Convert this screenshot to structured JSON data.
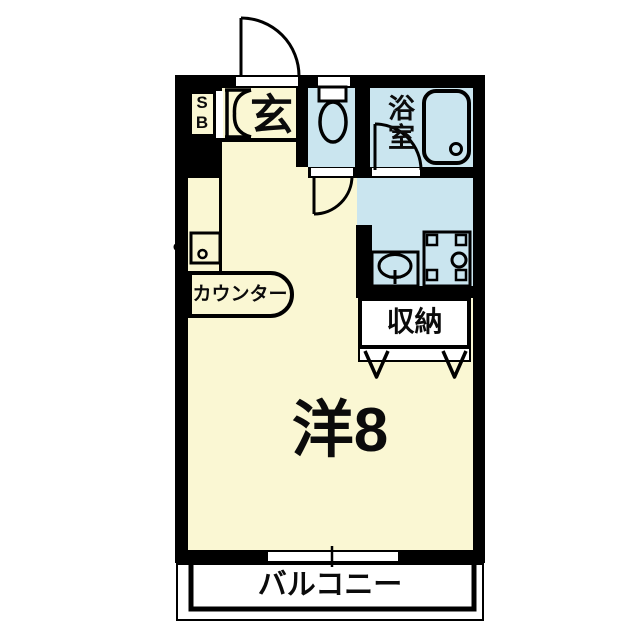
{
  "plan_type": "apartment-floor-plan",
  "rooms": {
    "shoe_box": {
      "label": "SB"
    },
    "entrance": {
      "label": "玄"
    },
    "bathroom": {
      "label": "浴室"
    },
    "counter": {
      "label": "カウンター"
    },
    "storage": {
      "label": "収納"
    },
    "main_room": {
      "label": "洋8"
    },
    "balcony": {
      "label": "バルコニー"
    }
  },
  "colors": {
    "floor": "#faf7d3",
    "wet_area": "#cae5ef",
    "wall": "#000000",
    "balcony": "#ffffff"
  },
  "icons": {
    "entrance-door-icon": "quarter-circle door swing at top wall",
    "shoebox-door-icon": "bi-fold bracket door next to SB",
    "toilet-icon": "tank rectangle with bowl oval",
    "toilet-door-icon": "quarter-circle door swing into hallway",
    "bathroom-door-icon": "quarter-circle door swing inside bath",
    "bathtub-icon": "rounded rectangle tub with drain circle",
    "washbasin-icon": "rectangle with oval basin and tap",
    "washing-machine-icon": "pan with corner tabs and drain circle",
    "stove-icon": "small burner box on wall with knob",
    "closet-door-icon": "two V fold marks under storage",
    "sliding-window-icon": "white opening with center tick in bottom wall"
  }
}
